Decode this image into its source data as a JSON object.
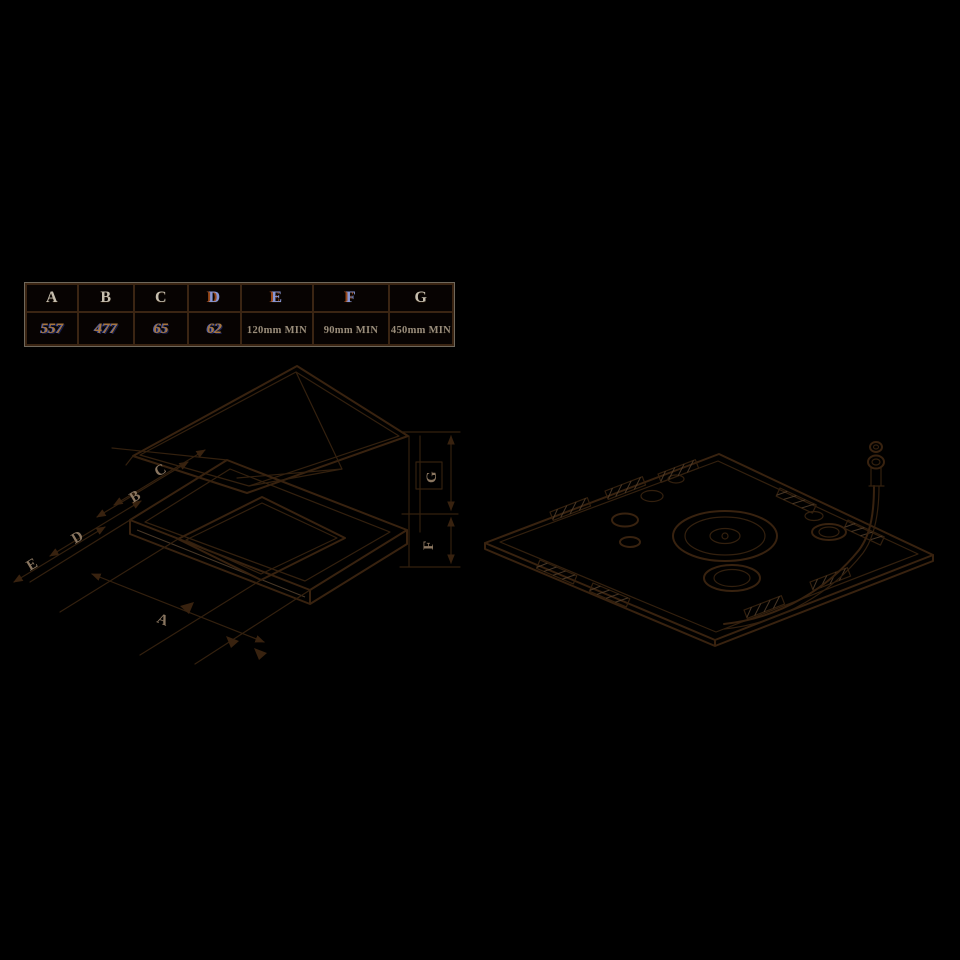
{
  "page": {
    "description": "Gas hob installation drawing: dimension table, worktop cut-out isometric view with lid, and underside view with gas pipe",
    "colors": {
      "background": "#000000",
      "line_ink": "#38220f",
      "line_highlight": "#5a4530",
      "table_border_brown": "#3b2513",
      "table_border_gray": "#7d766a",
      "header_text": "#c6beae",
      "header_text_blue": "#8796d4",
      "value_text_orange": "#a8763c",
      "value_text_gray": "#9a8d7b",
      "dimension_label": "#8a7660"
    }
  },
  "spec_table": {
    "columns": [
      {
        "label": "A",
        "value": "557"
      },
      {
        "label": "B",
        "value": "477"
      },
      {
        "label": "C",
        "value": "65"
      },
      {
        "label": "D",
        "value": "62"
      },
      {
        "label": "E",
        "value": "120mm MIN"
      },
      {
        "label": "F",
        "value": "90mm MIN"
      },
      {
        "label": "G",
        "value": "450mm MIN"
      }
    ]
  }
}
